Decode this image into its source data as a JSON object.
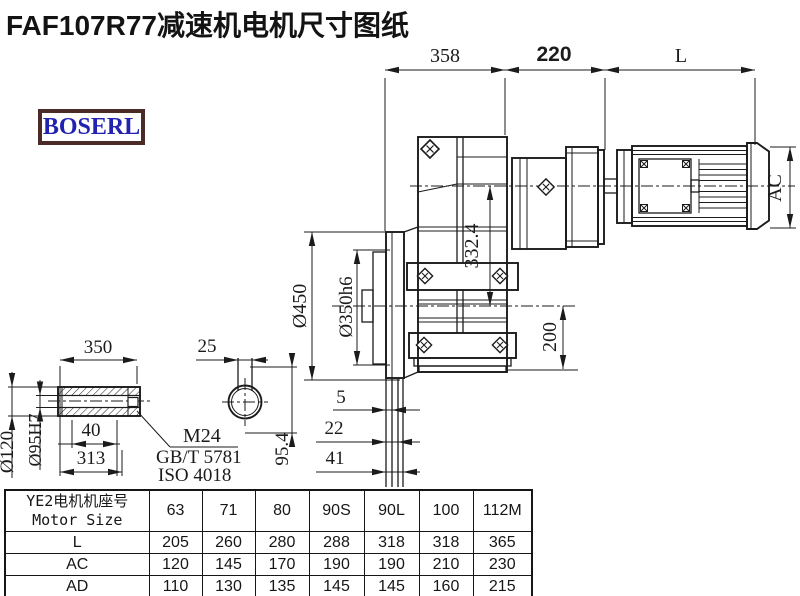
{
  "title": "FAF107R77减速机电机尺寸图纸",
  "logo": {
    "text": "BOSERL"
  },
  "colors": {
    "line": "#1b1b1b",
    "logo_border": "#4a2b28",
    "logo_text": "#2222b2"
  },
  "drawing": {
    "dims": {
      "gearbox_length": "358",
      "adapter_length": "220",
      "motor_length": "L",
      "motor_diameter": "AC",
      "axis_distance": "332.4",
      "center_to_bottom": "200",
      "flange_diameter": "Ø450",
      "spigot_diameter": "Ø350h6",
      "step_5": "5",
      "step_22": "22",
      "step_41": "41",
      "key_dim": "95.4",
      "hub_length": "350",
      "keyway_width": "25",
      "hub_od": "Ø120",
      "bore": "Ø95H7",
      "depth_40": "40",
      "depth_313": "313",
      "callout_thread": "M24",
      "callout_std1": "GB/T 5781",
      "callout_std2": "ISO 4018"
    }
  },
  "table": {
    "header_cn": "YE2电机机座号",
    "header_en": "Motor Size",
    "sizes": [
      "63",
      "71",
      "80",
      "90S",
      "90L",
      "100",
      "112M"
    ],
    "rows": [
      {
        "label": "L",
        "values": [
          "205",
          "260",
          "280",
          "288",
          "318",
          "318",
          "365"
        ]
      },
      {
        "label": "AC",
        "values": [
          "120",
          "145",
          "170",
          "190",
          "190",
          "210",
          "230"
        ]
      },
      {
        "label": "AD",
        "values": [
          "110",
          "130",
          "135",
          "145",
          "145",
          "160",
          "215"
        ]
      }
    ]
  }
}
